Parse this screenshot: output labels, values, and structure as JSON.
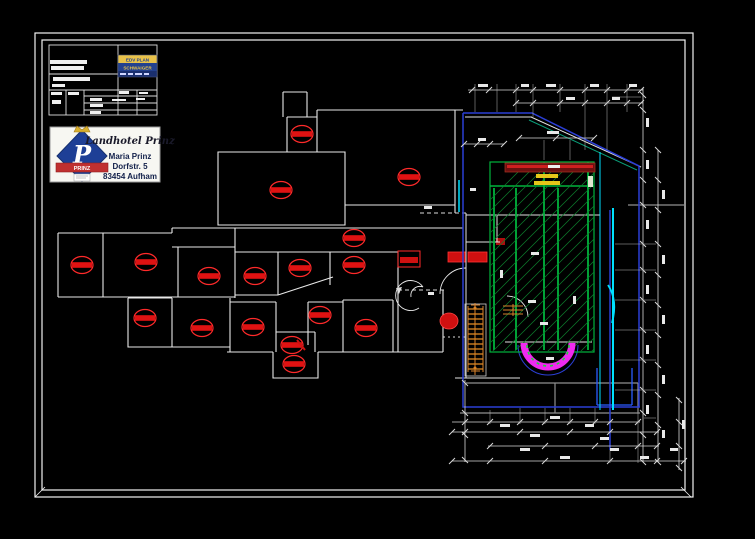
{
  "sheet": {
    "background": "#000000",
    "border_color": "#f2f2f2"
  },
  "colors": {
    "wall": "#e8e8e8",
    "gray": "#8f8f8f",
    "detector_red": "#e01212",
    "detector_outline": "#ff2a2a",
    "pool_green": "#00b43c",
    "hatch_green": "#0c7f2c",
    "cyan": "#00e0ff",
    "blue": "#2b3fd6",
    "bright_blue": "#2a5cff",
    "teal": "#0a9f7a",
    "magenta": "#f02af0",
    "orange": "#d9822b",
    "maroon": "#6b1010",
    "maroon_red": "#cf1f1f",
    "label_yellow": "#e6c619",
    "logo_yellow": "#e8c24a",
    "logo_blue": "#23418f",
    "logo_blue_dark": "#1a2f6e",
    "stamp_blue": "#1e3f96",
    "stamp_red": "#c03030",
    "stamp_gold": "#d8b030",
    "stamp_text": "#12204a"
  },
  "vendor_logo": {
    "line1": "EDV PLAN",
    "line2": "SCHWAIGER",
    "line3_dashes": true
  },
  "stamp": {
    "script_name": "Landhotel Prinz",
    "monogram": "P",
    "band_text": "PRINZ",
    "contact_name": "Maria Prinz",
    "street": "Dorfstr. 5",
    "city": "83454 Aufham"
  },
  "plan": {
    "detectors": [
      [
        302,
        134
      ],
      [
        281,
        190
      ],
      [
        409,
        177
      ],
      [
        354,
        238
      ],
      [
        82,
        265
      ],
      [
        146,
        262
      ],
      [
        209,
        276
      ],
      [
        255,
        276
      ],
      [
        300,
        268
      ],
      [
        354,
        265
      ],
      [
        145,
        318
      ],
      [
        202,
        328
      ],
      [
        253,
        327
      ],
      [
        320,
        315
      ],
      [
        366,
        328
      ],
      [
        292,
        345
      ],
      [
        294,
        364
      ]
    ]
  },
  "dims": {
    "h_chains": [
      {
        "y": 90,
        "x1": 468,
        "x2": 643,
        "ticks": [
          472,
          489,
          516,
          533,
          560,
          585,
          607,
          627,
          641
        ]
      },
      {
        "y": 103,
        "x1": 515,
        "x2": 643,
        "ticks": [
          516,
          533,
          560,
          585,
          607,
          627,
          641
        ]
      },
      {
        "y": 138,
        "x1": 519,
        "x2": 594,
        "ticks": [
          519,
          556,
          594
        ]
      },
      {
        "y": 144,
        "x1": 464,
        "x2": 504,
        "ticks": [
          464,
          477,
          490,
          504
        ]
      },
      {
        "y": 422,
        "x1": 452,
        "x2": 640,
        "ticks": [
          465,
          490,
          520,
          545,
          570,
          595,
          610,
          638
        ]
      },
      {
        "y": 432,
        "x1": 452,
        "x2": 659,
        "ticks": [
          452,
          465,
          520,
          570,
          610,
          657
        ]
      },
      {
        "y": 446,
        "x1": 488,
        "x2": 659,
        "ticks": [
          490,
          545,
          595,
          638,
          657
        ]
      },
      {
        "y": 461,
        "x1": 452,
        "x2": 686,
        "ticks": [
          452,
          490,
          545,
          610,
          657,
          684
        ]
      }
    ],
    "v_chains": [
      {
        "x": 643,
        "y1": 88,
        "y2": 462,
        "ticks": [
          95,
          110,
          150,
          180,
          205,
          244,
          270,
          300,
          330,
          360,
          390,
          413,
          435,
          462
        ]
      },
      {
        "x": 658,
        "y1": 150,
        "y2": 462,
        "ticks": [
          150,
          180,
          210,
          244,
          275,
          305,
          335,
          365,
          395,
          425,
          462
        ]
      },
      {
        "x": 679,
        "y1": 398,
        "y2": 470,
        "ticks": [
          400,
          422,
          446,
          468
        ]
      },
      {
        "x": 465,
        "y1": 380,
        "y2": 462,
        "ticks": [
          383,
          413,
          435,
          460
        ]
      }
    ],
    "ext_v": [
      [
        475,
        84,
        112
      ],
      [
        497,
        84,
        112
      ],
      [
        516,
        84,
        112
      ],
      [
        533,
        84,
        117
      ],
      [
        560,
        84,
        112
      ],
      [
        585,
        84,
        150
      ],
      [
        607,
        84,
        150
      ],
      [
        627,
        84,
        112
      ],
      [
        490,
        410,
        424
      ],
      [
        520,
        408,
        424
      ],
      [
        545,
        408,
        424
      ],
      [
        570,
        408,
        424
      ],
      [
        595,
        408,
        424
      ],
      [
        610,
        450,
        463
      ],
      [
        638,
        413,
        463
      ],
      [
        544,
        140,
        160
      ],
      [
        570,
        140,
        160
      ]
    ],
    "ext_h": [
      [
        244,
        615,
        656
      ],
      [
        270,
        615,
        656
      ],
      [
        300,
        615,
        656
      ],
      [
        330,
        615,
        656
      ],
      [
        360,
        615,
        656
      ],
      [
        390,
        615,
        656
      ],
      [
        418,
        644,
        656
      ],
      [
        97,
        612,
        641
      ]
    ],
    "labels": [
      [
        478,
        84,
        10,
        3
      ],
      [
        521,
        84,
        8,
        3
      ],
      [
        546,
        84,
        10,
        3
      ],
      [
        566,
        97,
        9,
        3
      ],
      [
        590,
        84,
        9,
        3
      ],
      [
        612,
        97,
        8,
        3
      ],
      [
        629,
        84,
        8,
        3
      ],
      [
        547,
        131,
        12,
        3
      ],
      [
        478,
        138,
        8,
        3
      ],
      [
        646,
        118,
        3,
        9
      ],
      [
        646,
        160,
        3,
        9
      ],
      [
        662,
        190,
        3,
        9
      ],
      [
        646,
        220,
        3,
        9
      ],
      [
        662,
        255,
        3,
        9
      ],
      [
        646,
        285,
        3,
        9
      ],
      [
        662,
        315,
        3,
        9
      ],
      [
        646,
        345,
        3,
        9
      ],
      [
        662,
        375,
        3,
        9
      ],
      [
        646,
        405,
        3,
        9
      ],
      [
        682,
        420,
        3,
        9
      ],
      [
        662,
        430,
        3,
        8
      ],
      [
        500,
        424,
        10,
        3
      ],
      [
        550,
        416,
        10,
        3
      ],
      [
        585,
        424,
        9,
        3
      ],
      [
        530,
        434,
        10,
        3
      ],
      [
        600,
        437,
        9,
        3
      ],
      [
        520,
        448,
        10,
        3
      ],
      [
        610,
        448,
        9,
        3
      ],
      [
        560,
        456,
        10,
        3
      ],
      [
        640,
        456,
        9,
        3
      ],
      [
        670,
        448,
        8,
        3
      ],
      [
        424,
        206,
        8,
        3
      ],
      [
        470,
        188,
        6,
        3
      ],
      [
        531,
        252,
        8,
        3
      ],
      [
        528,
        300,
        8,
        3
      ],
      [
        540,
        322,
        8,
        3
      ],
      [
        546,
        357,
        8,
        3
      ],
      [
        573,
        296,
        3,
        8
      ],
      [
        500,
        270,
        3,
        8
      ],
      [
        428,
        292,
        6,
        3
      ]
    ]
  }
}
